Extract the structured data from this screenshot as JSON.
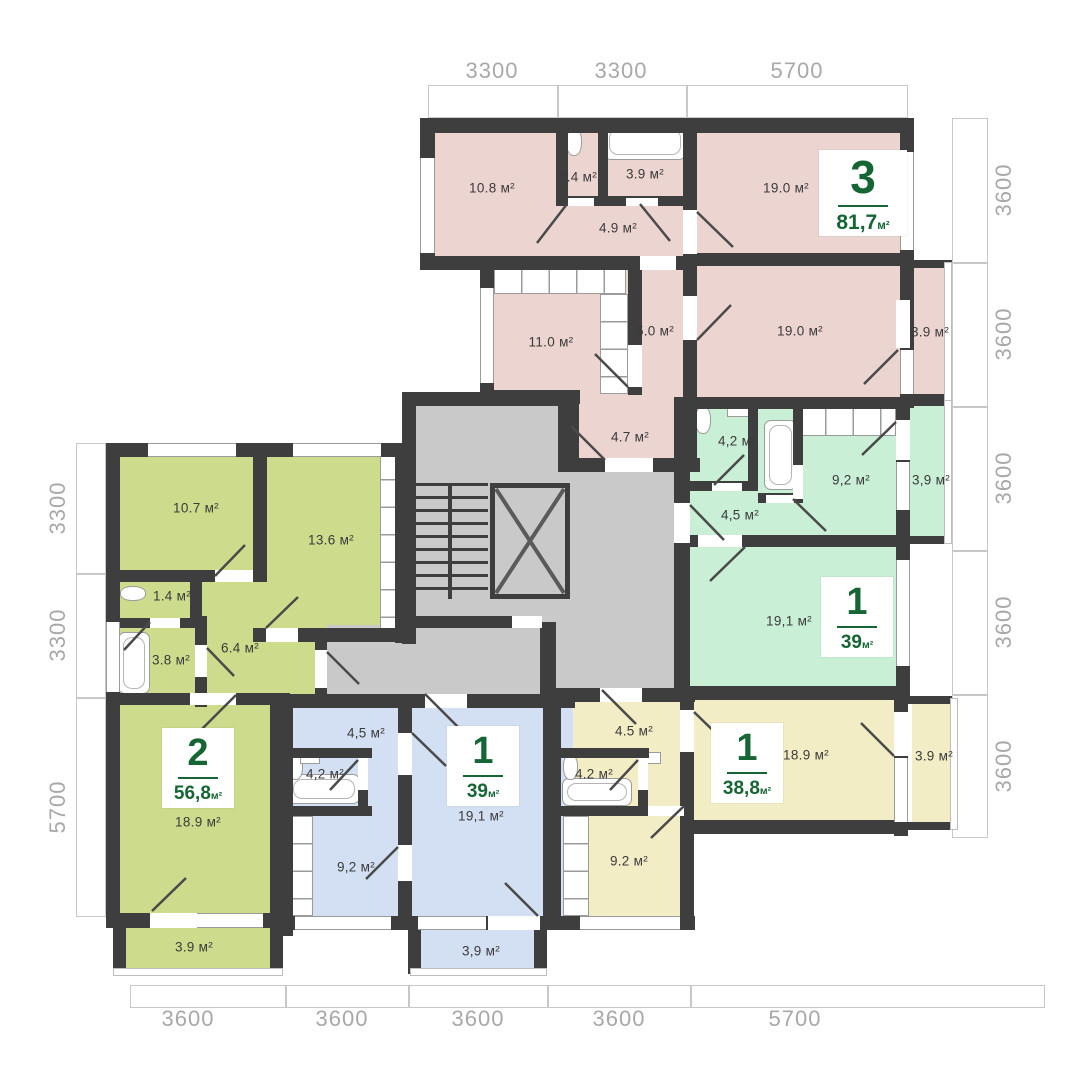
{
  "plan": {
    "title": "Residential floor plan",
    "wall_color": "#3e3e3e",
    "core_color": "#c9c9c9",
    "outline_color": "#c8c8c8",
    "dim_text_color": "#a8a8a8",
    "accent_green": "#166534",
    "room_text_color": "#3b3b3b",
    "area_unit": "м²"
  },
  "apartments": [
    {
      "key": "pink",
      "name": "3-room apartment",
      "color": "#ecd5d0",
      "badge": {
        "number": "3",
        "area": "81,7",
        "unit": "м²",
        "x": 863,
        "y": 193
      },
      "rooms": [
        {
          "label": "10.8 м²",
          "x": 492,
          "y": 188
        },
        {
          "label": "1.4 м²",
          "x": 578,
          "y": 177
        },
        {
          "label": "3.9 м²",
          "x": 645,
          "y": 174
        },
        {
          "label": "4.9 м²",
          "x": 618,
          "y": 228
        },
        {
          "label": "19.0 м²",
          "x": 786,
          "y": 188
        },
        {
          "label": "11.0 м²",
          "x": 551,
          "y": 342
        },
        {
          "label": "5.0 м²",
          "x": 655,
          "y": 331
        },
        {
          "label": "19.0 м²",
          "x": 800,
          "y": 331
        },
        {
          "label": "3.9 м²",
          "x": 930,
          "y": 332
        },
        {
          "label": "4.7 м²",
          "x": 630,
          "y": 437
        }
      ]
    },
    {
      "key": "mint",
      "name": "1-room apartment",
      "color": "#c9efd6",
      "badge": {
        "number": "1",
        "area": "39",
        "unit": "м²",
        "x": 857,
        "y": 617
      },
      "rooms": [
        {
          "label": "4,2 м²",
          "x": 737,
          "y": 441
        },
        {
          "label": "4,5 м²",
          "x": 740,
          "y": 515
        },
        {
          "label": "9,2 м²",
          "x": 851,
          "y": 480
        },
        {
          "label": "3,9 м²",
          "x": 931,
          "y": 480
        },
        {
          "label": "19,1 м²",
          "x": 789,
          "y": 621
        }
      ]
    },
    {
      "key": "yellow",
      "name": "1-room apartment",
      "color": "#f3edc6",
      "badge": {
        "number": "1",
        "area": "38,8",
        "unit": "м²",
        "x": 747,
        "y": 763
      },
      "rooms": [
        {
          "label": "4.5 м²",
          "x": 634,
          "y": 731
        },
        {
          "label": "4.2 м²",
          "x": 594,
          "y": 774
        },
        {
          "label": "9.2 м²",
          "x": 629,
          "y": 861
        },
        {
          "label": "18.9 м²",
          "x": 806,
          "y": 755
        },
        {
          "label": "3.9 м²",
          "x": 934,
          "y": 756
        }
      ]
    },
    {
      "key": "blue",
      "name": "1-room apartment",
      "color": "#d3e0f3",
      "badge": {
        "number": "1",
        "area": "39",
        "unit": "м²",
        "x": 483,
        "y": 766
      },
      "rooms": [
        {
          "label": "4,5 м²",
          "x": 366,
          "y": 733
        },
        {
          "label": "4,2 м²",
          "x": 325,
          "y": 774
        },
        {
          "label": "9,2 м²",
          "x": 356,
          "y": 867
        },
        {
          "label": "19,1 м²",
          "x": 481,
          "y": 816
        },
        {
          "label": "3,9 м²",
          "x": 481,
          "y": 951
        }
      ]
    },
    {
      "key": "lime",
      "name": "2-room apartment",
      "color": "#ccdc8c",
      "badge": {
        "number": "2",
        "area": "56,8",
        "unit": "м²",
        "x": 198,
        "y": 768
      },
      "rooms": [
        {
          "label": "10.7 м²",
          "x": 196,
          "y": 508
        },
        {
          "label": "13.6 м²",
          "x": 331,
          "y": 540
        },
        {
          "label": "1.4 м²",
          "x": 172,
          "y": 596
        },
        {
          "label": "3.8 м²",
          "x": 171,
          "y": 660
        },
        {
          "label": "6.4 м²",
          "x": 240,
          "y": 648
        },
        {
          "label": "18.9 м²",
          "x": 198,
          "y": 822
        },
        {
          "label": "3.9 м²",
          "x": 194,
          "y": 947
        }
      ]
    }
  ],
  "dimensions": {
    "top": [
      {
        "label": "3300",
        "x": 492,
        "y": 71
      },
      {
        "label": "3300",
        "x": 621,
        "y": 71
      },
      {
        "label": "5700",
        "x": 797,
        "y": 71
      }
    ],
    "right": [
      {
        "label": "3600",
        "x": 1004,
        "y": 190
      },
      {
        "label": "3600",
        "x": 1004,
        "y": 334
      },
      {
        "label": "3600",
        "x": 1004,
        "y": 478
      },
      {
        "label": "3600",
        "x": 1004,
        "y": 622
      },
      {
        "label": "3600",
        "x": 1004,
        "y": 766
      }
    ],
    "left": [
      {
        "label": "3300",
        "x": 58,
        "y": 508
      },
      {
        "label": "3300",
        "x": 58,
        "y": 635
      },
      {
        "label": "5700",
        "x": 58,
        "y": 807
      }
    ],
    "bottom": [
      {
        "label": "3600",
        "x": 188,
        "y": 1019
      },
      {
        "label": "3600",
        "x": 342,
        "y": 1019
      },
      {
        "label": "3600",
        "x": 478,
        "y": 1019
      },
      {
        "label": "3600",
        "x": 619,
        "y": 1019
      },
      {
        "label": "5700",
        "x": 795,
        "y": 1019
      }
    ]
  }
}
